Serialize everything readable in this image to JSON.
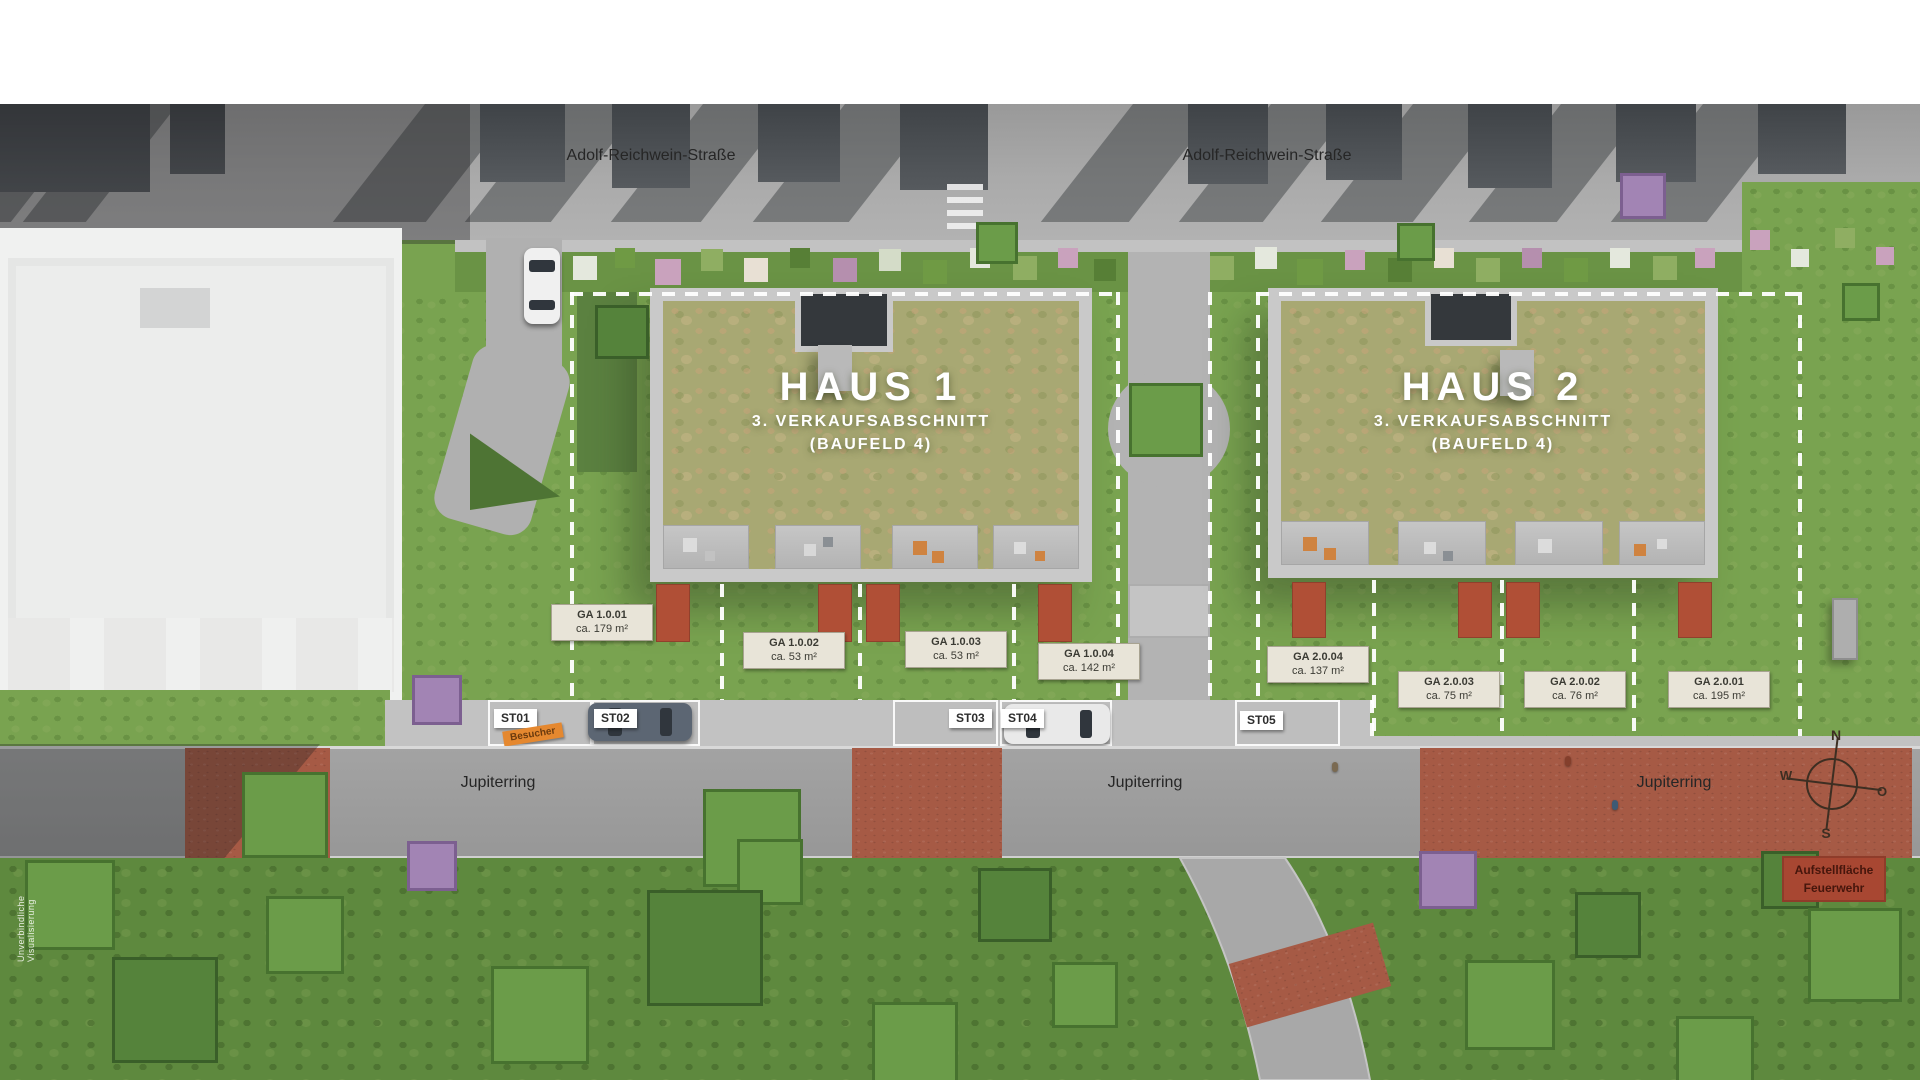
{
  "streets": {
    "adolf_reichwein": "Adolf-Reichwein-Straße",
    "jupiterring": "Jupiterring"
  },
  "houses": [
    {
      "name": "HAUS 1",
      "phase": "3. VERKAUFSABSCHNITT",
      "field": "(BAUFELD 4)"
    },
    {
      "name": "HAUS 2",
      "phase": "3. VERKAUFSABSCHNITT",
      "field": "(BAUFELD 4)"
    }
  ],
  "garden_areas": [
    {
      "id": "GA 1.0.01",
      "size": "ca. 179 m²"
    },
    {
      "id": "GA 1.0.02",
      "size": "ca. 53 m²"
    },
    {
      "id": "GA 1.0.03",
      "size": "ca. 53 m²"
    },
    {
      "id": "GA 1.0.04",
      "size": "ca. 142 m²"
    },
    {
      "id": "GA 2.0.04",
      "size": "ca. 137 m²"
    },
    {
      "id": "GA 2.0.03",
      "size": "ca. 75 m²"
    },
    {
      "id": "GA 2.0.02",
      "size": "ca. 76 m²"
    },
    {
      "id": "GA 2.0.01",
      "size": "ca. 195 m²"
    }
  ],
  "parking_spots": [
    {
      "id": "ST01"
    },
    {
      "id": "ST02"
    },
    {
      "id": "ST03"
    },
    {
      "id": "ST04"
    },
    {
      "id": "ST05"
    }
  ],
  "visitor_tag": "Besucher",
  "fire_lane": {
    "line1": "Aufstellfläche",
    "line2": "Feuerwehr"
  },
  "compass": {
    "n": "N",
    "e": "O",
    "s": "S",
    "w": "W"
  },
  "watermark": "Unverbindliche Visualisierung",
  "colors": {
    "fire_lane_red": "#a84732",
    "red_paving": "#a65a45",
    "visitor_orange": "#e5882f",
    "label_beige": "#e8e4d8",
    "dash_white": "#ffffff"
  }
}
